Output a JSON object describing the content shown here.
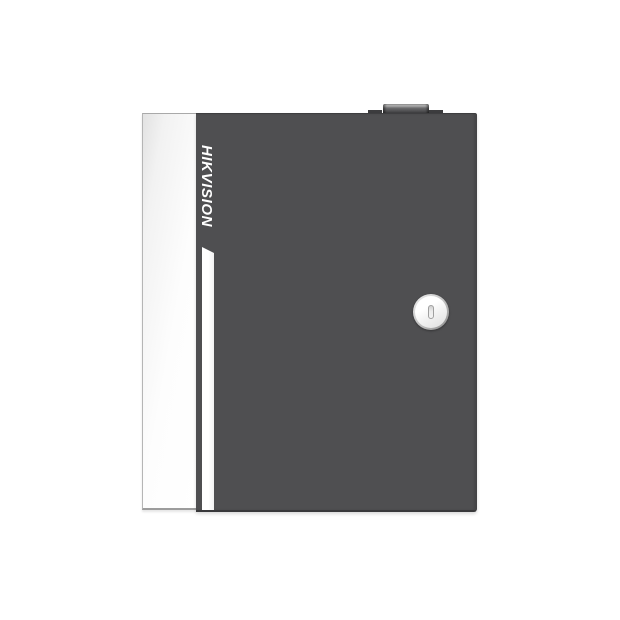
{
  "product": {
    "brand": "HIKVISION"
  },
  "colors": {
    "door_body": "#4f4f51",
    "door_edge_dark": "#3a3a3c",
    "side_panel": "#f2f2f2",
    "side_panel_border": "#a9a9a9",
    "stripe": "#ffffff",
    "brand_text": "#ffffff",
    "lock_ring": "#8a8a8a",
    "lock_face": "#f5f5f5",
    "keyhole_slot_border": "#9f9f9f",
    "top_knob_dark": "#424244",
    "top_knob_highlight": "#d8d8d8",
    "background": "#ffffff"
  }
}
